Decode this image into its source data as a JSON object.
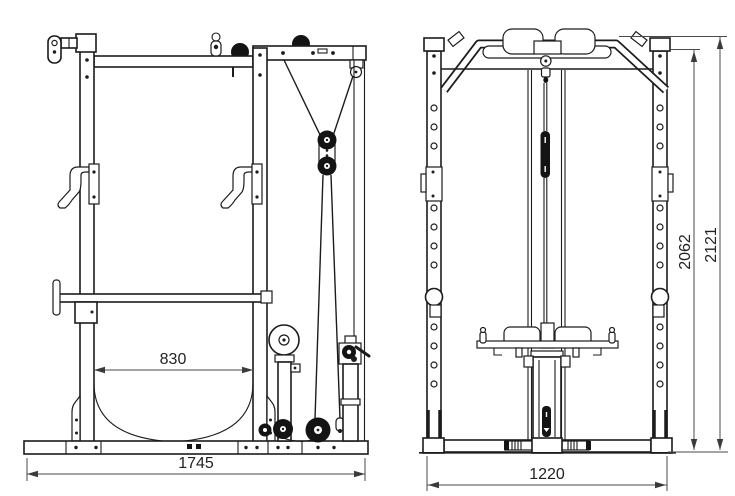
{
  "page": {
    "background": "#ffffff"
  },
  "drawing": {
    "ink_color": "#1c1c1c",
    "dimension_line_color": "#4a4a4a",
    "dimensions": {
      "inner_depth": {
        "label": "830"
      },
      "overall_depth": {
        "label": "1745"
      },
      "overall_width": {
        "label": "1220"
      },
      "frame_height": {
        "label": "2062"
      },
      "overall_height": {
        "label": "2121"
      }
    }
  }
}
